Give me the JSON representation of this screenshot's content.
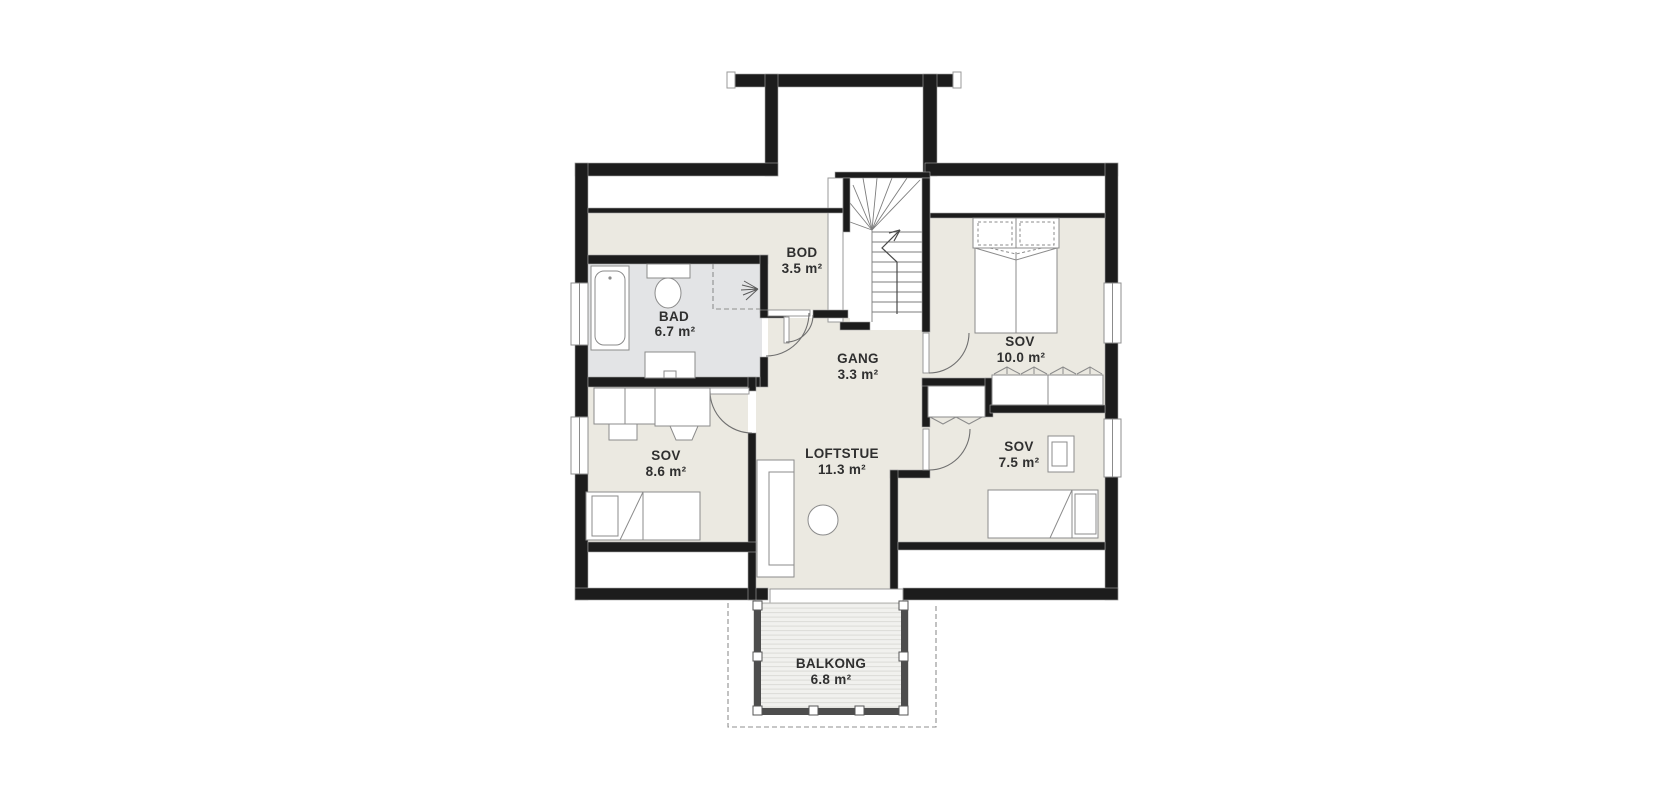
{
  "floorplan": {
    "title": "Loft floor plan",
    "rooms": {
      "bod": {
        "name": "BOD",
        "area": "3.5 m²"
      },
      "bad": {
        "name": "BAD",
        "area": "6.7 m²"
      },
      "gang": {
        "name": "GANG",
        "area": "3.3 m²"
      },
      "sov_10": {
        "name": "SOV",
        "area": "10.0 m²"
      },
      "sov_8_6": {
        "name": "SOV",
        "area": "8.6 m²"
      },
      "loftstue": {
        "name": "LOFTSTUE",
        "area": "11.3 m²"
      },
      "sov_7_5": {
        "name": "SOV",
        "area": "7.5 m²"
      },
      "balkong": {
        "name": "BALKONG",
        "area": "6.8 m²"
      }
    },
    "colors": {
      "wall": "#1c1c1c",
      "floor": "#ebe9e1",
      "bathroom_floor": "#e3e4e6",
      "furniture_stroke": "#8b8b8b",
      "balcony_railing": "#4d4d4d",
      "deck": "#f1f1ee",
      "deck_plank_line": "#dcdcd8",
      "dashed_line": "#8f8f8f",
      "label_text": "#2f2f2f",
      "background": "#ffffff"
    }
  }
}
